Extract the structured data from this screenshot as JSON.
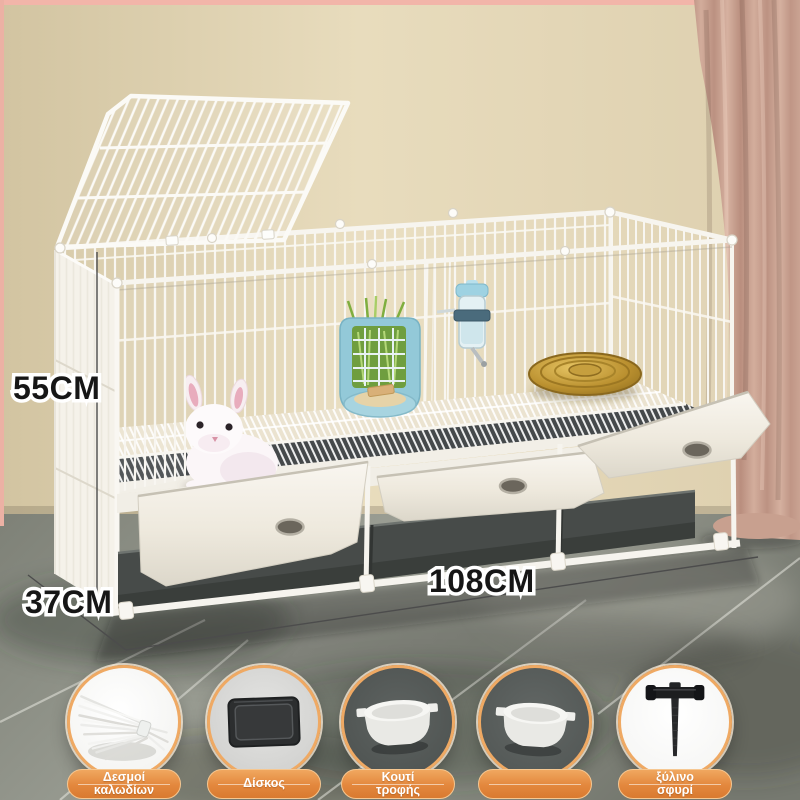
{
  "product_scene": {
    "dimensions": {
      "height_label": "55CM",
      "depth_label": "37CM",
      "width_label": "108CM"
    }
  },
  "accessory_items": [
    {
      "name": "cable-ties",
      "label_line1": "Δεσμοί",
      "label_line2": "καλωδίων"
    },
    {
      "name": "tray",
      "label_line1": "Δίσκος",
      "label_line2": ""
    },
    {
      "name": "food-box",
      "label_line1": "Κουτί",
      "label_line2": "τροφής"
    },
    {
      "name": "feeder-bowl",
      "label_line1": "",
      "label_line2": ""
    },
    {
      "name": "wooden-hammer",
      "label_line1": "ξύλινο",
      "label_line2": "σφυρί"
    }
  ],
  "colors": {
    "accent_orange": "#e8883f",
    "pill_border": "#f6c791",
    "ring_orange": "#efa963",
    "wall_beige": "#e2d5b5",
    "curtain_rose": "#c79e8e",
    "floor_marble": "#8e9187",
    "cage_white": "#f7f5ef",
    "tray_dark": "#474b49",
    "feeder_blue": "#8ec7d6",
    "basket_tan": "#c69a3a",
    "label_text": "#ffffff",
    "dimension_text": "#161616"
  }
}
